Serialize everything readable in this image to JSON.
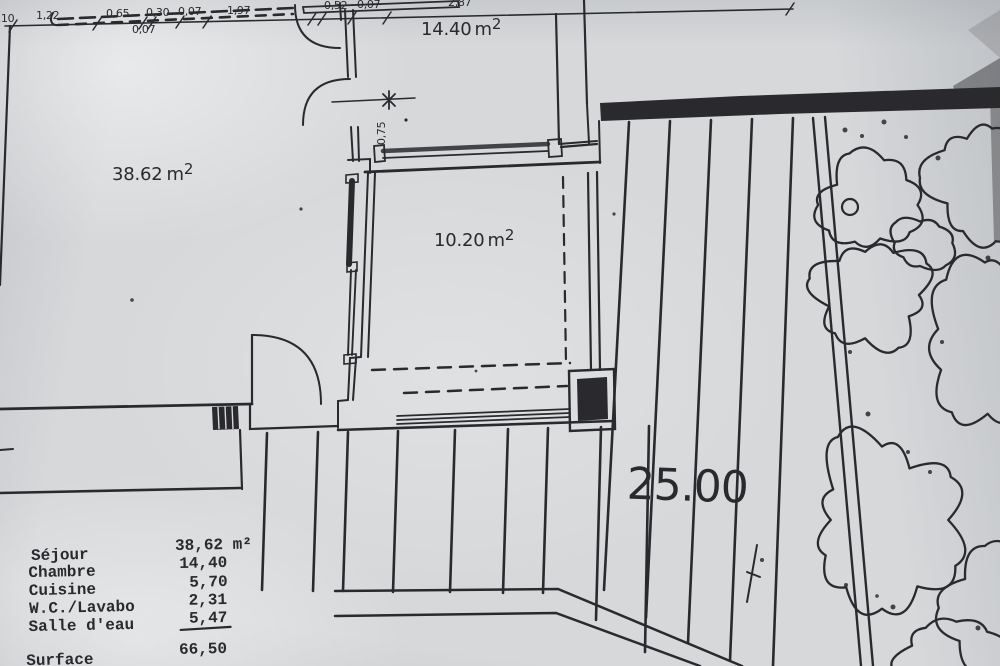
{
  "plan": {
    "rooms": [
      {
        "name": "sejour",
        "area": "38.62",
        "unit_base": "m",
        "unit_sup": "2"
      },
      {
        "name": "chambre",
        "area": "14.40",
        "unit_base": "m",
        "unit_sup": "2"
      },
      {
        "name": "veranda",
        "area": "10.20",
        "unit_base": "m",
        "unit_sup": "2"
      }
    ],
    "top_dims": [
      "0,10",
      "1,22",
      "0,65",
      "0,30",
      "0,07",
      "0,07",
      "1,97",
      "0,52",
      "0,07",
      "2,87"
    ],
    "passage_dim": "0,75",
    "terrace_label": "25.00"
  },
  "legend": {
    "rows": [
      {
        "label": "Séjour",
        "value": "38,62 m²"
      },
      {
        "label": "Chambre",
        "value": "14,40"
      },
      {
        "label": "Cuisine",
        "value": "5,70"
      },
      {
        "label": "W.C./Lavabo",
        "value": "2,31"
      },
      {
        "label": "Salle d'eau",
        "value": "5,47"
      }
    ],
    "total_label": "Surface",
    "total_value": "66,50"
  },
  "colors": {
    "paper": "#d6d8da",
    "ink": "#2a2a2e"
  }
}
